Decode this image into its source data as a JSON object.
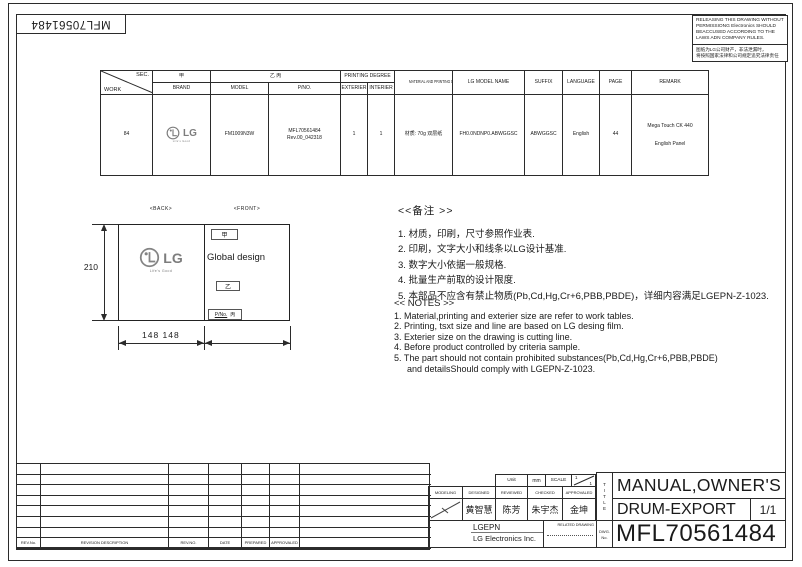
{
  "doc": {
    "part_number_rotated": "MFL70561484"
  },
  "warning": {
    "en": "RELEASING THIS DRAWING WITHOUT PERMISSIONG Electronics SHOULD BEACCUSED ACCORDING TO THE LAWS ADN COMPANY RULES.",
    "zh1": "图纸为LG公司财产，非法泄漏时，",
    "zh2": "将按照国家法律和公司规定追究法律责任"
  },
  "spec": {
    "corner_top": "SEC.",
    "corner_bottom": "WORK",
    "h_jia": "甲",
    "h_brand": "BRAND",
    "h_yibing": "乙 丙",
    "h_model": "MODEL",
    "h_pno": "P/NO.",
    "h_printing": "PRINTING DEGREE",
    "h_ext": "EXTERIER",
    "h_int": "INTERIER",
    "h_material": "MATERIAL AND PRINTING DESCRIPTION",
    "h_lgmodel": "LG MODEL NAME",
    "h_suffix": "SUFFIX",
    "h_lang": "LANGUAGE",
    "h_page": "PAGE",
    "h_remark": "REMARK",
    "work": "84",
    "logo_lg": "LG",
    "logo_tagline": "Life's Good",
    "model": "FM1009N3W",
    "pno1": "MFL70561484",
    "pno2": "Rev.00_042318",
    "ext": "1",
    "int": "1",
    "material": "材质: 70g 双层纸",
    "lg_model": "FH0.0NDNP0.ABWGGSC",
    "suffix": "ABWGGSC",
    "language": "English",
    "page": "44",
    "remark1": "Mega Touch CK 440",
    "remark2": "English Panel"
  },
  "drawing": {
    "back": "<BACK>",
    "front": "<FRONT>",
    "dim_h": "210",
    "dim_w": "148 148",
    "jia": "甲",
    "yi": "乙",
    "pno_label": "P/No.",
    "bing": "丙",
    "global": "Global design",
    "logo_lg": "LG",
    "logo_tagline": "Life's Good"
  },
  "notes_cn": {
    "title": "<<备注 >>",
    "items": [
      "1.  材质，印刷，尺寸参照作业表.",
      "2.  印刷，文字大小和线条以LG设计基准.",
      "3.  数字大小依据一般规格.",
      "4.  批量生产前取的设计限度.",
      "5.  本部品不应含有禁止物质(Pb,Cd,Hg,Cr+6,PBB,PBDE)，详细内容满足LGEPN-Z-1023."
    ]
  },
  "notes_en": {
    "title": "<< NOTES >>",
    "items": [
      "1. Material,printing and exterier size are refer to work tables.",
      "2. Printing, tsxt  size and line are based on LG desing film.",
      "3. Exterier size on the drawing is cutting line.",
      "4. Before product controlled by criteria sample.",
      "5. The part should not contain prohibited substances(Pb,Cd,Hg,Cr+6,PBB,PBDE)",
      "and detailsShould comply with LGEPN-Z-1023."
    ]
  },
  "revision": {
    "headers": [
      "REV.No.",
      "REVISION DESCRIPTION",
      "REV.NO.",
      "DATE",
      "PREPARED",
      "APPROVALED"
    ]
  },
  "tb": {
    "unit": "Unit",
    "unit_val": "mm",
    "scale": "SCALE",
    "s1": "1",
    "s2": "1",
    "modeling": "MODELING",
    "designed": "DESIGNED",
    "reviewed": "REVIEWED",
    "checked": "CHECKED",
    "approvaled": "APPROVALED",
    "n_designed": "黄智慧",
    "n_reviewed": "陈芳",
    "n_checked": "朱宇杰",
    "n_approvaled": "金坤",
    "company": "LGEPN",
    "company2": "LG Electronics Inc.",
    "related": "RELATED DRAWING",
    "title_letters": [
      "T",
      "I",
      "T",
      "L",
      "E"
    ],
    "dwg1": "DWG.",
    "dwg2": "No.",
    "title1": "MANUAL,OWNER'S",
    "title2": "DRUM-EXPORT",
    "sheet": "1/1",
    "number": "MFL70561484"
  }
}
